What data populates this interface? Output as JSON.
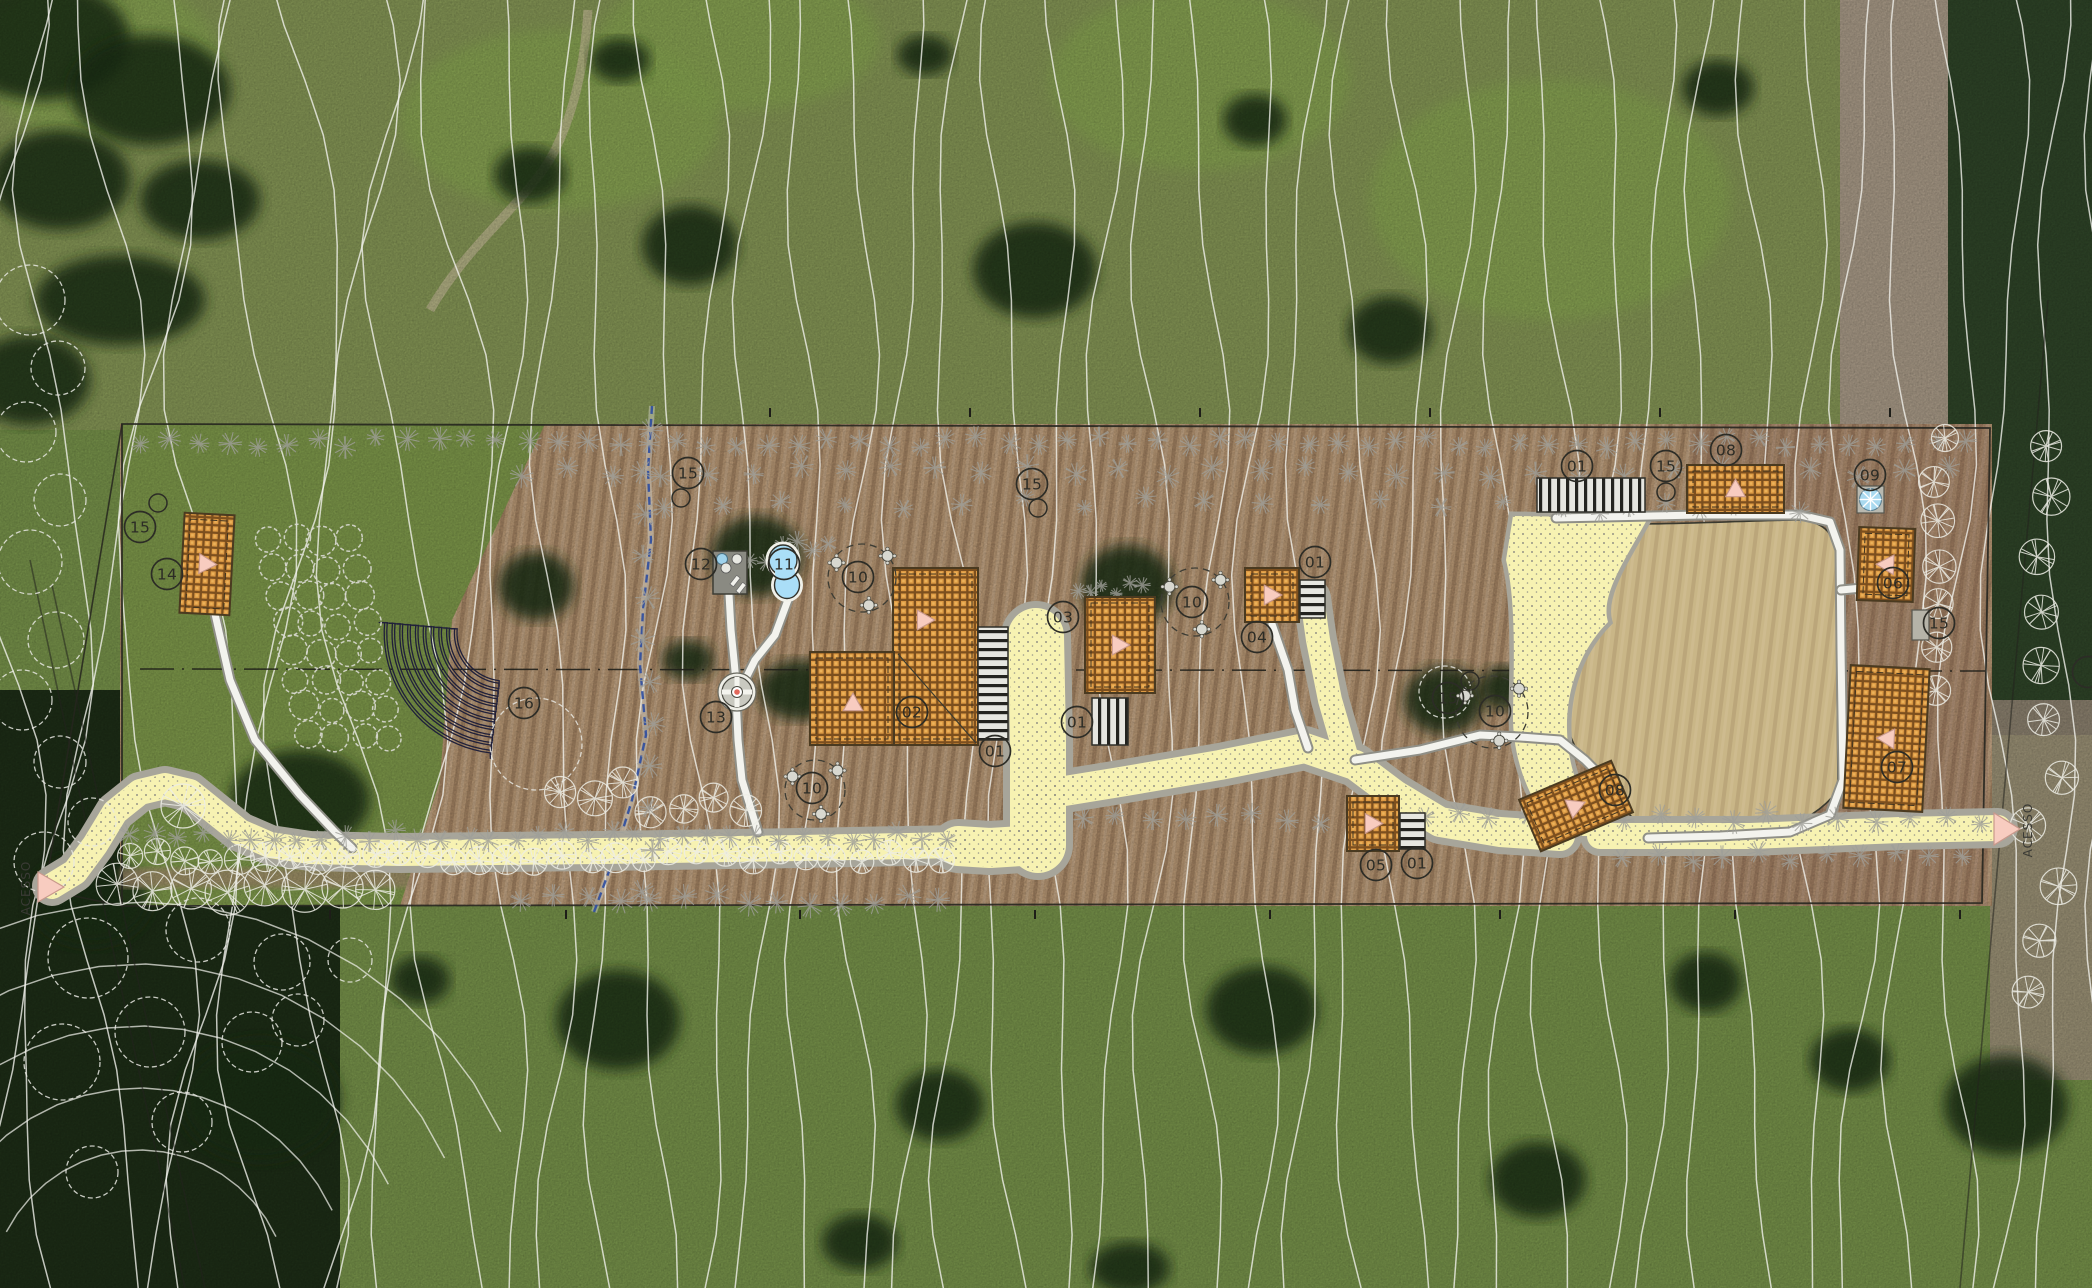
{
  "canvas": {
    "w": 2092,
    "h": 1288
  },
  "site": {
    "access_label": "ACESSO",
    "access_points": [
      {
        "x": 38,
        "y": 887,
        "tri": [
          [
            38,
            872
          ],
          [
            38,
            902
          ],
          [
            64,
            887
          ]
        ],
        "tx": 30,
        "ty": 888
      },
      {
        "x": 2020,
        "y": 829,
        "tri": [
          [
            1994,
            813
          ],
          [
            1994,
            845
          ],
          [
            2020,
            829
          ]
        ],
        "tx": 2032,
        "ty": 830
      }
    ]
  },
  "callouts": [
    {
      "n": "15",
      "x": 140,
      "y": 527,
      "lx": 158,
      "ly": 503
    },
    {
      "n": "14",
      "x": 167,
      "y": 574
    },
    {
      "n": "15",
      "x": 688,
      "y": 473,
      "lx": 681,
      "ly": 498
    },
    {
      "n": "12",
      "x": 701,
      "y": 564
    },
    {
      "n": "11",
      "x": 784,
      "y": 564
    },
    {
      "n": "10",
      "x": 858,
      "y": 577
    },
    {
      "n": "13",
      "x": 716,
      "y": 717
    },
    {
      "n": "16",
      "x": 524,
      "y": 703
    },
    {
      "n": "10",
      "x": 812,
      "y": 788
    },
    {
      "n": "02",
      "x": 912,
      "y": 712
    },
    {
      "n": "01",
      "x": 995,
      "y": 751
    },
    {
      "n": "01",
      "x": 1077,
      "y": 722
    },
    {
      "n": "03",
      "x": 1063,
      "y": 617
    },
    {
      "n": "10",
      "x": 1192,
      "y": 602
    },
    {
      "n": "04",
      "x": 1257,
      "y": 637
    },
    {
      "n": "01",
      "x": 1315,
      "y": 562
    },
    {
      "n": "15",
      "x": 1032,
      "y": 484,
      "lx": 1038,
      "ly": 508
    },
    {
      "n": "05",
      "x": 1376,
      "y": 865
    },
    {
      "n": "01",
      "x": 1417,
      "y": 863
    },
    {
      "n": "15",
      "x": 1448,
      "y": 698,
      "lx": 1470,
      "ly": 681
    },
    {
      "n": "10",
      "x": 1495,
      "y": 711
    },
    {
      "n": "01",
      "x": 1577,
      "y": 466
    },
    {
      "n": "15",
      "x": 1666,
      "y": 466,
      "lx": 1666,
      "ly": 492
    },
    {
      "n": "08",
      "x": 1726,
      "y": 450
    },
    {
      "n": "09",
      "x": 1870,
      "y": 475
    },
    {
      "n": "06",
      "x": 1893,
      "y": 583
    },
    {
      "n": "15",
      "x": 1939,
      "y": 623
    },
    {
      "n": "07",
      "x": 1897,
      "y": 767
    },
    {
      "n": "08",
      "x": 1615,
      "y": 790
    },
    {
      "n": "",
      "x": 2088,
      "y": 672
    }
  ],
  "furniture_zones": [
    {
      "x": 862,
      "y": 578,
      "r": 34
    },
    {
      "x": 815,
      "y": 790,
      "r": 30
    },
    {
      "x": 1195,
      "y": 602,
      "r": 34
    },
    {
      "x": 1492,
      "y": 712,
      "r": 36
    }
  ],
  "buildings": [
    {
      "x": 182,
      "y": 514,
      "w": 50,
      "h": 100,
      "rot": 3,
      "tri": "right"
    },
    {
      "x": 893,
      "y": 568,
      "w": 85,
      "h": 177,
      "rot": 0,
      "tri": "right",
      "tx": 925,
      "ty": 620
    },
    {
      "x": 810,
      "y": 652,
      "w": 84,
      "h": 93,
      "rot": 0,
      "tri": "up",
      "tx": 853,
      "ty": 703
    },
    {
      "x": 1085,
      "y": 597,
      "w": 70,
      "h": 96,
      "rot": 0,
      "tri": "right"
    },
    {
      "x": 1245,
      "y": 568,
      "w": 54,
      "h": 54,
      "rot": 0,
      "tri": "right"
    },
    {
      "x": 1347,
      "y": 796,
      "w": 52,
      "h": 55,
      "rot": 0,
      "tri": "right"
    },
    {
      "x": 1687,
      "y": 465,
      "w": 97,
      "h": 48,
      "rot": 0,
      "tri": "up"
    },
    {
      "x": 1526,
      "y": 778,
      "w": 100,
      "h": 56,
      "rot": -23,
      "tri": "right"
    },
    {
      "x": 1858,
      "y": 528,
      "w": 56,
      "h": 73,
      "rot": 2,
      "tri": "left"
    },
    {
      "x": 1847,
      "y": 667,
      "w": 79,
      "h": 143,
      "rot": 3,
      "tri": "left"
    }
  ],
  "building_diag": [
    898,
    654,
    976,
    743
  ],
  "pergolas": [
    {
      "x": 978,
      "y": 627,
      "w": 30,
      "h": 113,
      "dir": "h"
    },
    {
      "x": 1092,
      "y": 698,
      "w": 36,
      "h": 47,
      "dir": "v"
    },
    {
      "x": 1300,
      "y": 580,
      "w": 25,
      "h": 38,
      "dir": "h"
    },
    {
      "x": 1400,
      "y": 813,
      "w": 25,
      "h": 36,
      "dir": "h"
    },
    {
      "x": 1537,
      "y": 478,
      "w": 108,
      "h": 34,
      "dir": "v"
    }
  ],
  "features": {
    "deck": {
      "x": 713,
      "y": 551,
      "w": 34,
      "h": 43
    },
    "pool": {
      "cx1": 783,
      "cy1": 560,
      "rx1": 14,
      "ry1": 15,
      "cx2": 787,
      "cy2": 585,
      "rx2": 12.5,
      "ry2": 13.5
    },
    "fountain": {
      "x": 737,
      "y": 692,
      "r": 15
    },
    "spa": {
      "x": 1857,
      "y": 486,
      "s": 27
    },
    "pad15": {
      "x": 1912,
      "y": 610,
      "w": 17,
      "h": 30
    },
    "amphitheater": {
      "cx": 505,
      "cy": 633,
      "r0": 48,
      "count": 10,
      "dr": 7.8,
      "a0": 95,
      "a1": 185
    },
    "orchard": {
      "x0": 268,
      "y0": 540,
      "cols": 4,
      "rows": 8,
      "dx": 27,
      "dy": 28,
      "shear": 6,
      "r": 12
    },
    "field": "M1556,520 C1610,528 1700,522 1795,520 Q1835,520 1836,556 L1838,790 Q1810,828 1750,833 L1648,836 C1620,800 1572,762 1567,722 C1562,682 1582,642 1610,622 C1582,600 1566,560 1556,520 Z"
  },
  "paths": {
    "yellow_segments": [
      {
        "w": 26,
        "pts": [
          [
            52,
            886
          ],
          [
            75,
            872
          ],
          [
            95,
            845
          ],
          [
            115,
            812
          ],
          [
            140,
            792
          ],
          [
            165,
            786
          ],
          [
            190,
            792
          ],
          [
            215,
            812
          ],
          [
            240,
            832
          ],
          [
            270,
            845
          ],
          [
            310,
            851
          ],
          [
            400,
            853
          ],
          [
            600,
            851
          ],
          [
            800,
            848
          ],
          [
            960,
            845
          ]
        ]
      },
      {
        "w": 56,
        "pts": [
          [
            1036,
            636
          ],
          [
            1038,
            740
          ],
          [
            1038,
            845
          ]
        ]
      },
      {
        "w": 40,
        "pts": [
          [
            1038,
            845
          ],
          [
            990,
            848
          ],
          [
            958,
            846
          ]
        ]
      },
      {
        "w": 30,
        "pts": [
          [
            1040,
            795
          ],
          [
            1120,
            782
          ],
          [
            1220,
            765
          ],
          [
            1305,
            748
          ],
          [
            1355,
            765
          ],
          [
            1395,
            795
          ],
          [
            1440,
            822
          ],
          [
            1500,
            832
          ],
          [
            1560,
            836
          ]
        ]
      },
      {
        "w": 24,
        "pts": [
          [
            1312,
            598
          ],
          [
            1318,
            640
          ],
          [
            1330,
            700
          ],
          [
            1345,
            752
          ]
        ]
      },
      {
        "w": 26,
        "pts": [
          [
            1600,
            836
          ],
          [
            1750,
            836
          ],
          [
            1900,
            830
          ],
          [
            1998,
            828
          ]
        ]
      }
    ],
    "yellow_blob": "M1513,516 L1648,518 C1625,560 1600,595 1608,622 C1580,650 1566,690 1567,730 C1568,775 1585,810 1612,836 L1560,836 C1530,805 1512,760 1513,712 C1514,660 1516,600 1506,560 Z",
    "white_segments": [
      [
        [
          215,
          614
        ],
        [
          230,
          680
        ],
        [
          255,
          740
        ],
        [
          300,
          795
        ],
        [
          335,
          832
        ],
        [
          352,
          848
        ]
      ],
      [
        [
          729,
          594
        ],
        [
          731,
          630
        ],
        [
          734,
          660
        ],
        [
          736,
          682
        ]
      ],
      [
        [
          788,
          600
        ],
        [
          775,
          635
        ],
        [
          755,
          660
        ],
        [
          741,
          688
        ]
      ],
      [
        [
          736,
          696
        ],
        [
          738,
          740
        ],
        [
          742,
          780
        ],
        [
          758,
          832
        ]
      ],
      [
        [
          1272,
          624
        ],
        [
          1288,
          670
        ],
        [
          1295,
          710
        ],
        [
          1308,
          748
        ]
      ],
      [
        [
          1355,
          760
        ],
        [
          1420,
          750
        ],
        [
          1480,
          735
        ],
        [
          1520,
          737
        ],
        [
          1560,
          740
        ],
        [
          1585,
          760
        ],
        [
          1607,
          782
        ]
      ],
      [
        [
          1556,
          518
        ],
        [
          1700,
          515
        ],
        [
          1800,
          515
        ],
        [
          1830,
          522
        ],
        [
          1840,
          550
        ],
        [
          1841,
          650
        ],
        [
          1843,
          780
        ],
        [
          1830,
          815
        ],
        [
          1790,
          832
        ],
        [
          1720,
          836
        ],
        [
          1648,
          838
        ]
      ],
      [
        [
          1841,
          590
        ],
        [
          1862,
          588
        ]
      ]
    ]
  },
  "lines": {
    "boundary": [
      [
        122,
        424
      ],
      [
        1990,
        428
      ],
      [
        1982,
        903
      ],
      [
        122,
        906
      ]
    ],
    "boundary_left": [
      [
        [
          122,
          424
        ],
        [
          46,
          884
        ]
      ],
      [
        [
          46,
          890
        ],
        [
          122,
          906
        ]
      ]
    ],
    "centerline": [
      [
        140,
        669
      ],
      [
        1985,
        671
      ]
    ],
    "stream": [
      [
        652,
        406
      ],
      [
        648,
        470
      ],
      [
        651,
        540
      ],
      [
        643,
        610
      ],
      [
        640,
        665
      ],
      [
        646,
        735
      ],
      [
        632,
        800
      ],
      [
        615,
        855
      ],
      [
        594,
        912
      ]
    ],
    "property": [
      [
        [
          30,
          560
        ],
        [
          185,
          1288
        ]
      ],
      [
        [
          52,
          585
        ],
        [
          205,
          1288
        ]
      ],
      [
        [
          2048,
          300
        ],
        [
          1960,
          1288
        ]
      ]
    ]
  },
  "ticks": {
    "top": {
      "y": 417,
      "xs": [
        770,
        970,
        1200,
        1430,
        1660,
        1890
      ]
    },
    "bottom": {
      "y": 919,
      "xs": [
        330,
        566,
        800,
        1035,
        1270,
        1500,
        1735,
        1960
      ]
    }
  },
  "veg_rows": [
    {
      "t": "g",
      "x0": 135,
      "x1": 1985,
      "y": 442,
      "step": 30,
      "r": 9
    },
    {
      "t": "g",
      "x0": 520,
      "x1": 1985,
      "y": 472,
      "step": 46,
      "r": 10
    },
    {
      "t": "g",
      "x0": 660,
      "x1": 1560,
      "y": 503,
      "step": 60,
      "r": 8
    },
    {
      "t": "w",
      "x0": 128,
      "x1": 960,
      "y": 856,
      "step": 27,
      "r": 11
    },
    {
      "t": "g",
      "x0": 128,
      "x1": 960,
      "y": 836,
      "step": 24,
      "r": 9
    },
    {
      "t": "w",
      "x0": 115,
      "x1": 405,
      "y": 888,
      "step": 37,
      "r": 19
    },
    {
      "t": "g",
      "x0": 520,
      "x1": 950,
      "y": 900,
      "step": 32,
      "r": 10
    },
    {
      "t": "g",
      "x0": 1080,
      "x1": 1560,
      "y": 818,
      "step": 34,
      "r": 9
    },
    {
      "t": "g",
      "x0": 1620,
      "x1": 1985,
      "y": 818,
      "step": 36,
      "r": 9
    },
    {
      "t": "g",
      "x0": 1620,
      "x1": 1985,
      "y": 856,
      "step": 34,
      "r": 9
    },
    {
      "t": "g",
      "x0": 1075,
      "x1": 1150,
      "y": 588,
      "step": 13,
      "r": 6
    },
    {
      "t": "g",
      "x0": 1560,
      "x1": 1830,
      "y": 508,
      "step": 34,
      "r": 8
    },
    {
      "t": "w",
      "x0": 560,
      "x1": 740,
      "y": 795,
      "step": 30,
      "r": 14,
      "jy": 18
    },
    {
      "t": "g",
      "x0": 745,
      "x1": 830,
      "y": 545,
      "step": 16,
      "r": 8,
      "jy": 22
    },
    {
      "t": "w",
      "vert": 1,
      "x": 2045,
      "y0": 440,
      "y1": 1000,
      "step": 55,
      "r": 15,
      "jx": 18
    },
    {
      "t": "w",
      "vert": 1,
      "x": 1940,
      "y0": 435,
      "y1": 710,
      "step": 42,
      "r": 13,
      "jx": 10
    },
    {
      "t": "g",
      "vert": 1,
      "x": 648,
      "y0": 430,
      "y1": 900,
      "step": 42,
      "r": 10,
      "jx": 6
    }
  ],
  "clouds": [
    [
      30,
      300,
      35
    ],
    [
      58,
      368,
      27
    ],
    [
      26,
      432,
      30
    ],
    [
      60,
      500,
      26
    ],
    [
      30,
      562,
      32
    ],
    [
      56,
      640,
      28
    ],
    [
      22,
      700,
      30
    ],
    [
      60,
      762,
      26
    ],
    [
      92,
      822,
      24
    ],
    [
      44,
      862,
      30
    ],
    [
      88,
      958,
      40
    ],
    [
      198,
      930,
      32
    ],
    [
      282,
      962,
      28
    ],
    [
      150,
      1032,
      35
    ],
    [
      252,
      1042,
      30
    ],
    [
      62,
      1062,
      38
    ],
    [
      182,
      1122,
      30
    ],
    [
      92,
      1172,
      26
    ],
    [
      298,
      1020,
      26
    ],
    [
      350,
      960,
      22
    ],
    [
      536,
      744,
      46
    ],
    [
      1445,
      692,
      26
    ]
  ],
  "photo": {
    "dark_trees": [
      [
        40,
        40,
        90,
        60
      ],
      [
        150,
        90,
        80,
        55
      ],
      [
        60,
        180,
        70,
        50
      ],
      [
        200,
        200,
        60,
        40
      ],
      [
        120,
        300,
        85,
        45
      ],
      [
        30,
        380,
        60,
        45
      ],
      [
        690,
        245,
        48,
        40
      ],
      [
        1035,
        270,
        62,
        48
      ],
      [
        1255,
        120,
        32,
        26
      ],
      [
        1390,
        330,
        42,
        34
      ],
      [
        1718,
        88,
        36,
        28
      ],
      [
        925,
        55,
        28,
        20
      ],
      [
        530,
        175,
        36,
        28
      ],
      [
        620,
        60,
        30,
        22
      ],
      [
        757,
        556,
        46,
        40
      ],
      [
        536,
        586,
        38,
        34
      ],
      [
        800,
        690,
        42,
        30
      ],
      [
        688,
        660,
        26,
        20
      ],
      [
        1127,
        585,
        46,
        40
      ],
      [
        1444,
        700,
        40,
        34
      ],
      [
        1505,
        688,
        26,
        22
      ],
      [
        618,
        1020,
        62,
        50
      ],
      [
        940,
        1105,
        44,
        36
      ],
      [
        1262,
        1010,
        56,
        44
      ],
      [
        1538,
        1180,
        48,
        38
      ],
      [
        1706,
        982,
        36,
        30
      ],
      [
        2006,
        1105,
        62,
        50
      ],
      [
        860,
        1242,
        38,
        28
      ],
      [
        1130,
        1268,
        40,
        26
      ],
      [
        420,
        980,
        30,
        24
      ],
      [
        1850,
        1060,
        40,
        32
      ],
      [
        300,
        800,
        70,
        50
      ],
      [
        260,
        1100,
        80,
        60
      ],
      [
        90,
        900,
        60,
        45
      ]
    ],
    "bright_patches": [
      [
        560,
        120,
        160,
        90
      ],
      [
        740,
        40,
        140,
        70
      ],
      [
        100,
        60,
        120,
        80
      ],
      [
        1550,
        200,
        180,
        120
      ],
      [
        1200,
        80,
        150,
        90
      ]
    ]
  },
  "colors": {
    "grass": "#7d9a4e",
    "grass_bright": "#8fb054",
    "grass_olive": "#99a265",
    "strip_tan": "#c2a07b",
    "field_tan": "#c9b687",
    "mauve": "#b3a291",
    "forest": "#31482a",
    "forest_dark": "#1f3018",
    "contour": "#f4f4ee",
    "ink": "#2c2c26",
    "yellow": "#f7f2b2",
    "path_border": "#a7a59a",
    "white_path": "#f3f3ee",
    "white_path_edge": "#8f8f87",
    "hatch_dark": "#7c4f1e",
    "hatch_orange": "#dd9a44",
    "building_outline": "#4a3a20",
    "tri_fill": "#f8ccc0",
    "tri_stroke": "#c9998c",
    "pool": "#aadef7",
    "stream": "#2c4da0",
    "veg_gray": "#9f9f99",
    "veg_white": "#eeeee6",
    "deck": "#8a8a82"
  }
}
